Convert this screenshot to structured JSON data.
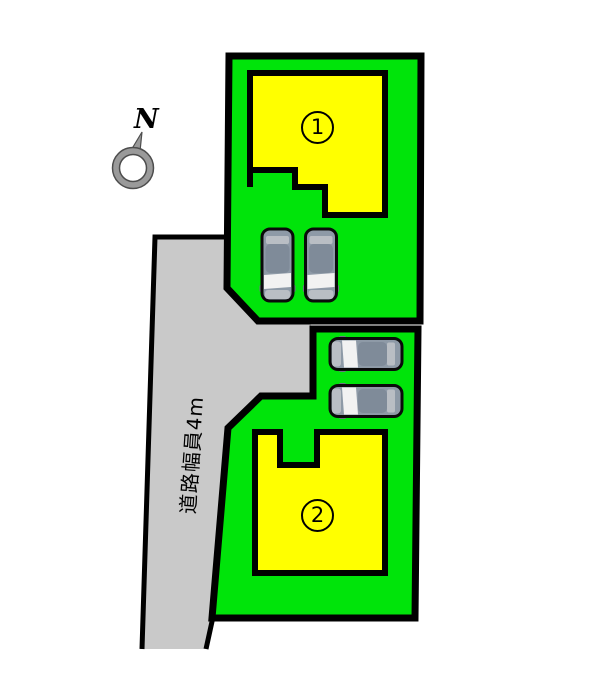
{
  "compass": {
    "label": "N"
  },
  "road": {
    "label": "道路幅員4m"
  },
  "lots": [
    {
      "number": "1"
    },
    {
      "number": "2"
    }
  ],
  "colors": {
    "lot_green": "#00e40a",
    "building_yellow": "#ffff00",
    "road_gray": "#c9c9c9",
    "outline_black": "#000000",
    "car_body": "#8e9aa7",
    "car_roof": "#7f8b99",
    "car_trim": "#b9bec4",
    "windshield_white": "#f2f2f2",
    "compass_gray": "#9a9a9a"
  },
  "icons": {
    "compass": "compass-north-icon",
    "car": "car-top-view-icon"
  }
}
